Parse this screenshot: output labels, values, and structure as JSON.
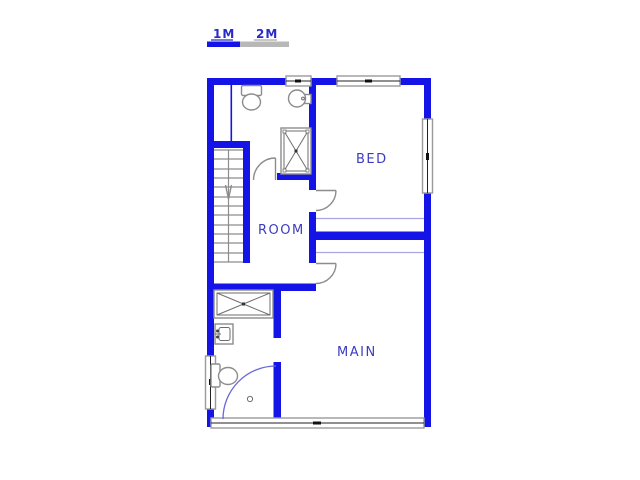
{
  "scale_bar": {
    "label_1m": "1M",
    "label_2m": "2M",
    "segment_1_color": "#1414e6",
    "segment_2_color": "#b8b8b8"
  },
  "rooms": {
    "bed": "BED",
    "room": "ROOM",
    "main": "MAIN"
  },
  "colors": {
    "wall": "#1414e6",
    "room_label": "#3c3cc0",
    "scale_label": "#2a2ac8",
    "window_frame": "#9a9a9a",
    "fixture_outline": "#8c8c8c",
    "thin_level_line": "#a6a6e0",
    "door_swing": "#8c8c8c",
    "blue_door_swing": "#6868d8",
    "background": "#ffffff"
  },
  "icons": {
    "stairs": "stairs-with-down-arrow",
    "shower": "shower-tray-icon",
    "bathtub": "bathtub-icon",
    "toilet_top": "toilet-icon",
    "toilet_bottom": "toilet-icon",
    "basin_top": "wash-basin-icon",
    "basin_bottom": "wash-basin-icon"
  }
}
